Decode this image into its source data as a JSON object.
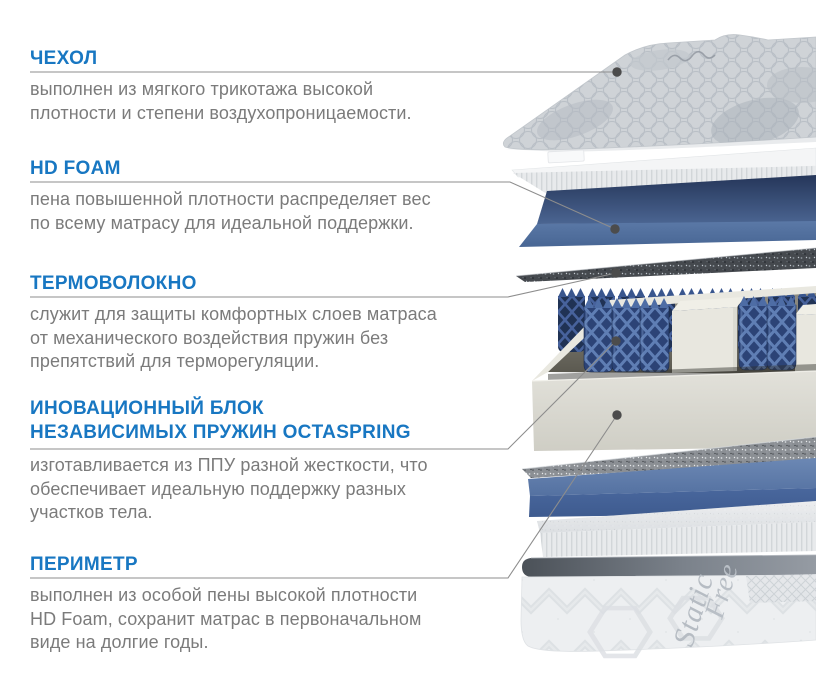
{
  "palette": {
    "accent_blue": "#1877c2",
    "body_text_gray": "#7b7b7b",
    "pointer_line_gray": "#8d8d8d",
    "foam_blue": "#5474a3",
    "spring_navy": "#2c4376",
    "foam_cream": "#e8e7df"
  },
  "sections": [
    {
      "id": "cover",
      "heading_lines": [
        "ЧЕХОЛ"
      ],
      "body_lines": [
        "выполнен из мягкого трикотажа высокой",
        "плотности и степени воздухопроницаемости."
      ]
    },
    {
      "id": "hd-foam",
      "heading_lines": [
        "HD FOAM"
      ],
      "body_lines": [
        "пена повышенной плотности распределяет вес",
        "по всему матрасу для идеальной поддержки."
      ]
    },
    {
      "id": "thermal-fiber",
      "heading_lines": [
        "ТЕРМОВОЛОКНО"
      ],
      "body_lines": [
        "служит для защиты комфортных слоев матраса",
        "от механического воздействия пружин без",
        "препятствий для терморегуляции."
      ]
    },
    {
      "id": "spring-block",
      "heading_lines": [
        "ИНОВАЦИОННЫЙ БЛОК",
        "НЕЗАВИСИМЫХ ПРУЖИН OCTASPRING"
      ],
      "body_lines": [
        "изготавливается из ППУ разной жесткости, что",
        "обеспечивает идеальную поддержку разных",
        "участков тела."
      ]
    },
    {
      "id": "perimeter",
      "heading_lines": [
        "ПЕРИМЕТР"
      ],
      "body_lines": [
        "выполнен из особой пены высокой плотности",
        "HD Foam, сохранит матрас в первоначальном",
        "виде на долгие годы."
      ]
    }
  ],
  "illustration": {
    "base_label_lines": [
      "Static",
      "Free"
    ]
  }
}
